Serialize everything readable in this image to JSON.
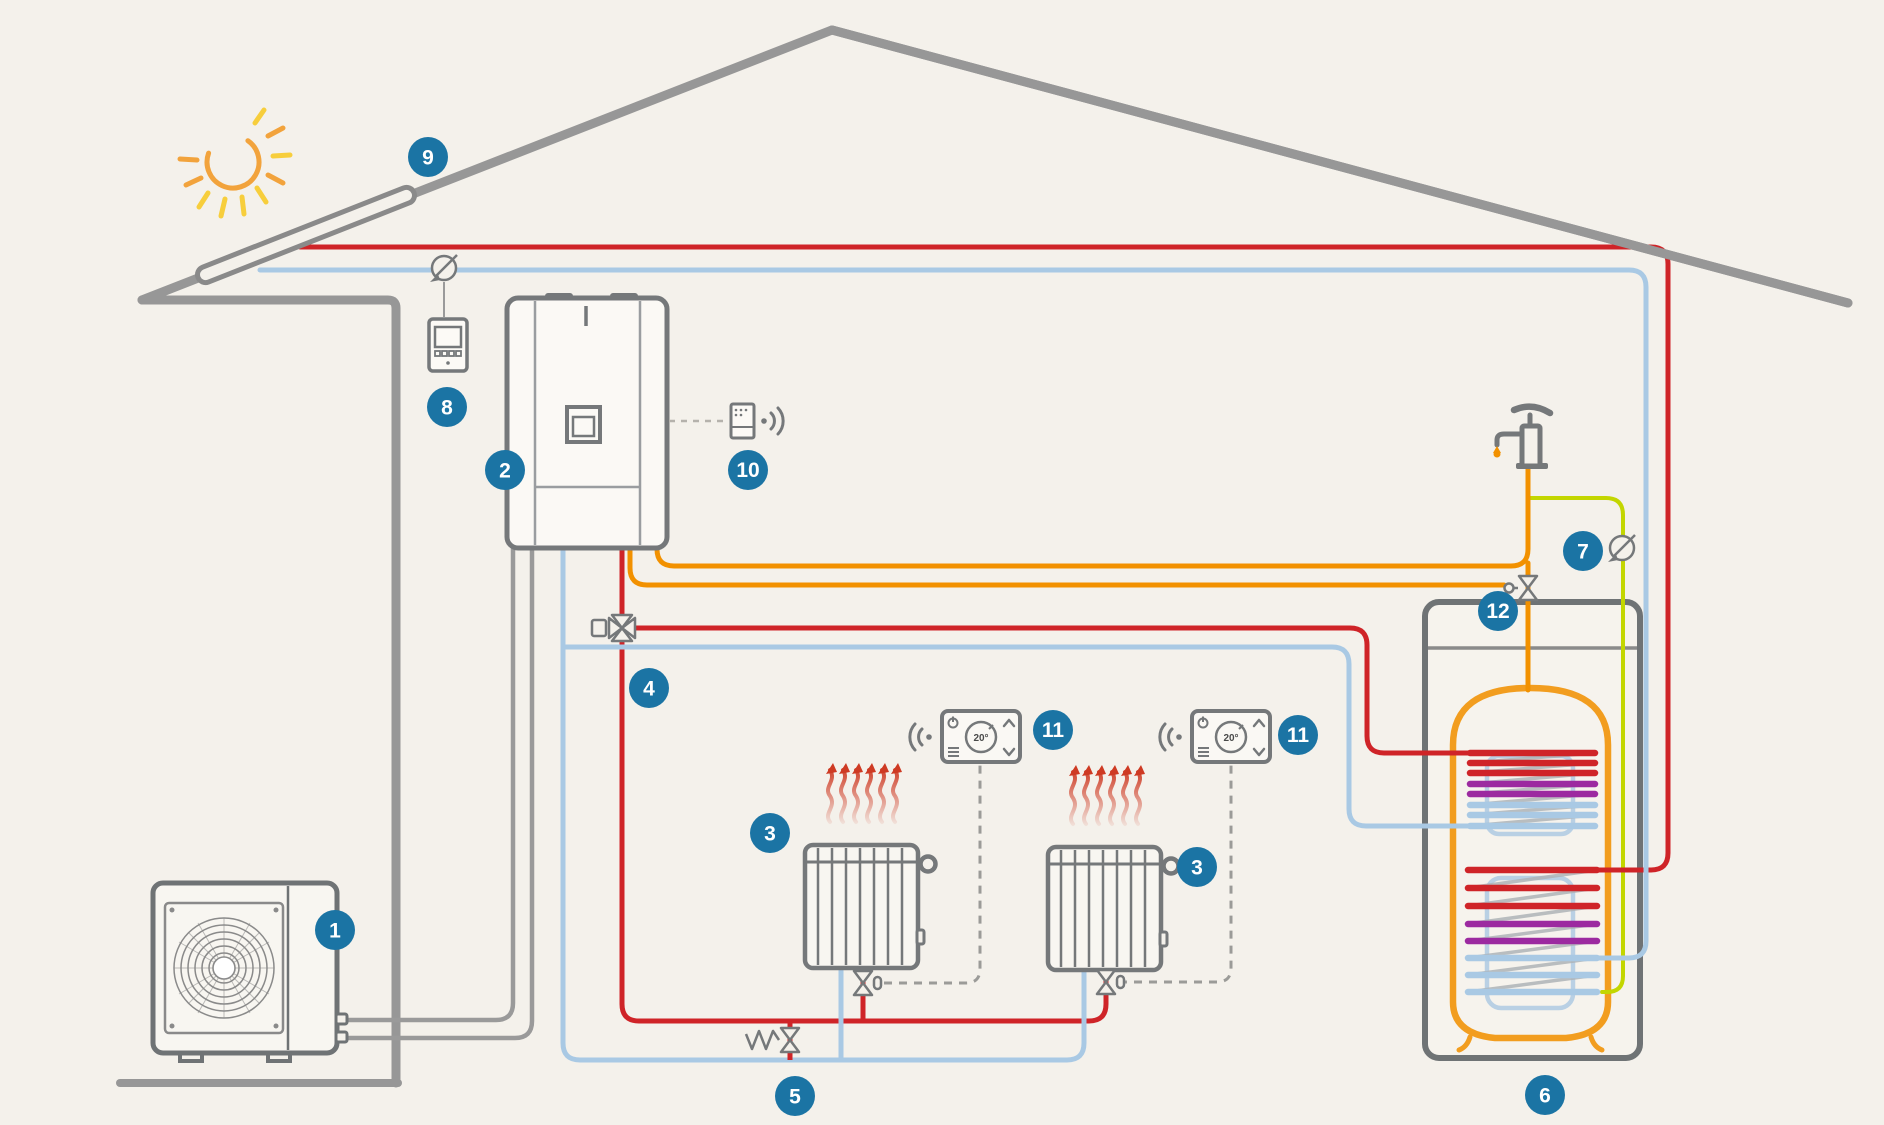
{
  "diagram_type": "heating-system-schematic",
  "callouts": {
    "outdoor_unit": "1",
    "indoor_unit": "2",
    "radiator": "3",
    "mixing_valve": "4",
    "bypass_valve": "5",
    "storage_tank": "6",
    "dhw_sensor": "7",
    "solar_controller": "8",
    "solar_collector": "9",
    "gateway": "10",
    "room_thermostat": "11",
    "dhw_valve": "12"
  },
  "thermostat": {
    "temperature_display": "20°"
  },
  "icons": {
    "sun": "sun-icon",
    "solar_collector": "solar-collector-icon",
    "temperature_sensor": "temperature-sensor-icon",
    "wireless_signal": "wireless-signal-icon",
    "water_tap": "water-tap-icon",
    "valve": "valve-icon",
    "heat_waves": "heat-waves-icon"
  },
  "colors": {
    "background": "#F4F1EB",
    "callout_bg": "#1B74A4",
    "pipe_hot": "#CF2428",
    "pipe_cold": "#A9C9E4",
    "pipe_dhw_orange": "#F29100",
    "pipe_sensor_lime": "#C3D600",
    "pipe_refrigerant": "#9A9A9A",
    "structure_gray": "#979797",
    "device_outline": "#75787A",
    "tank_body_orange": "#F29D1F",
    "coil_purple": "#9C2AA0",
    "sun_orange": "#F2A33C",
    "sun_yellow": "#F7CE3C",
    "heat_wave_red": "#CE3A23"
  }
}
